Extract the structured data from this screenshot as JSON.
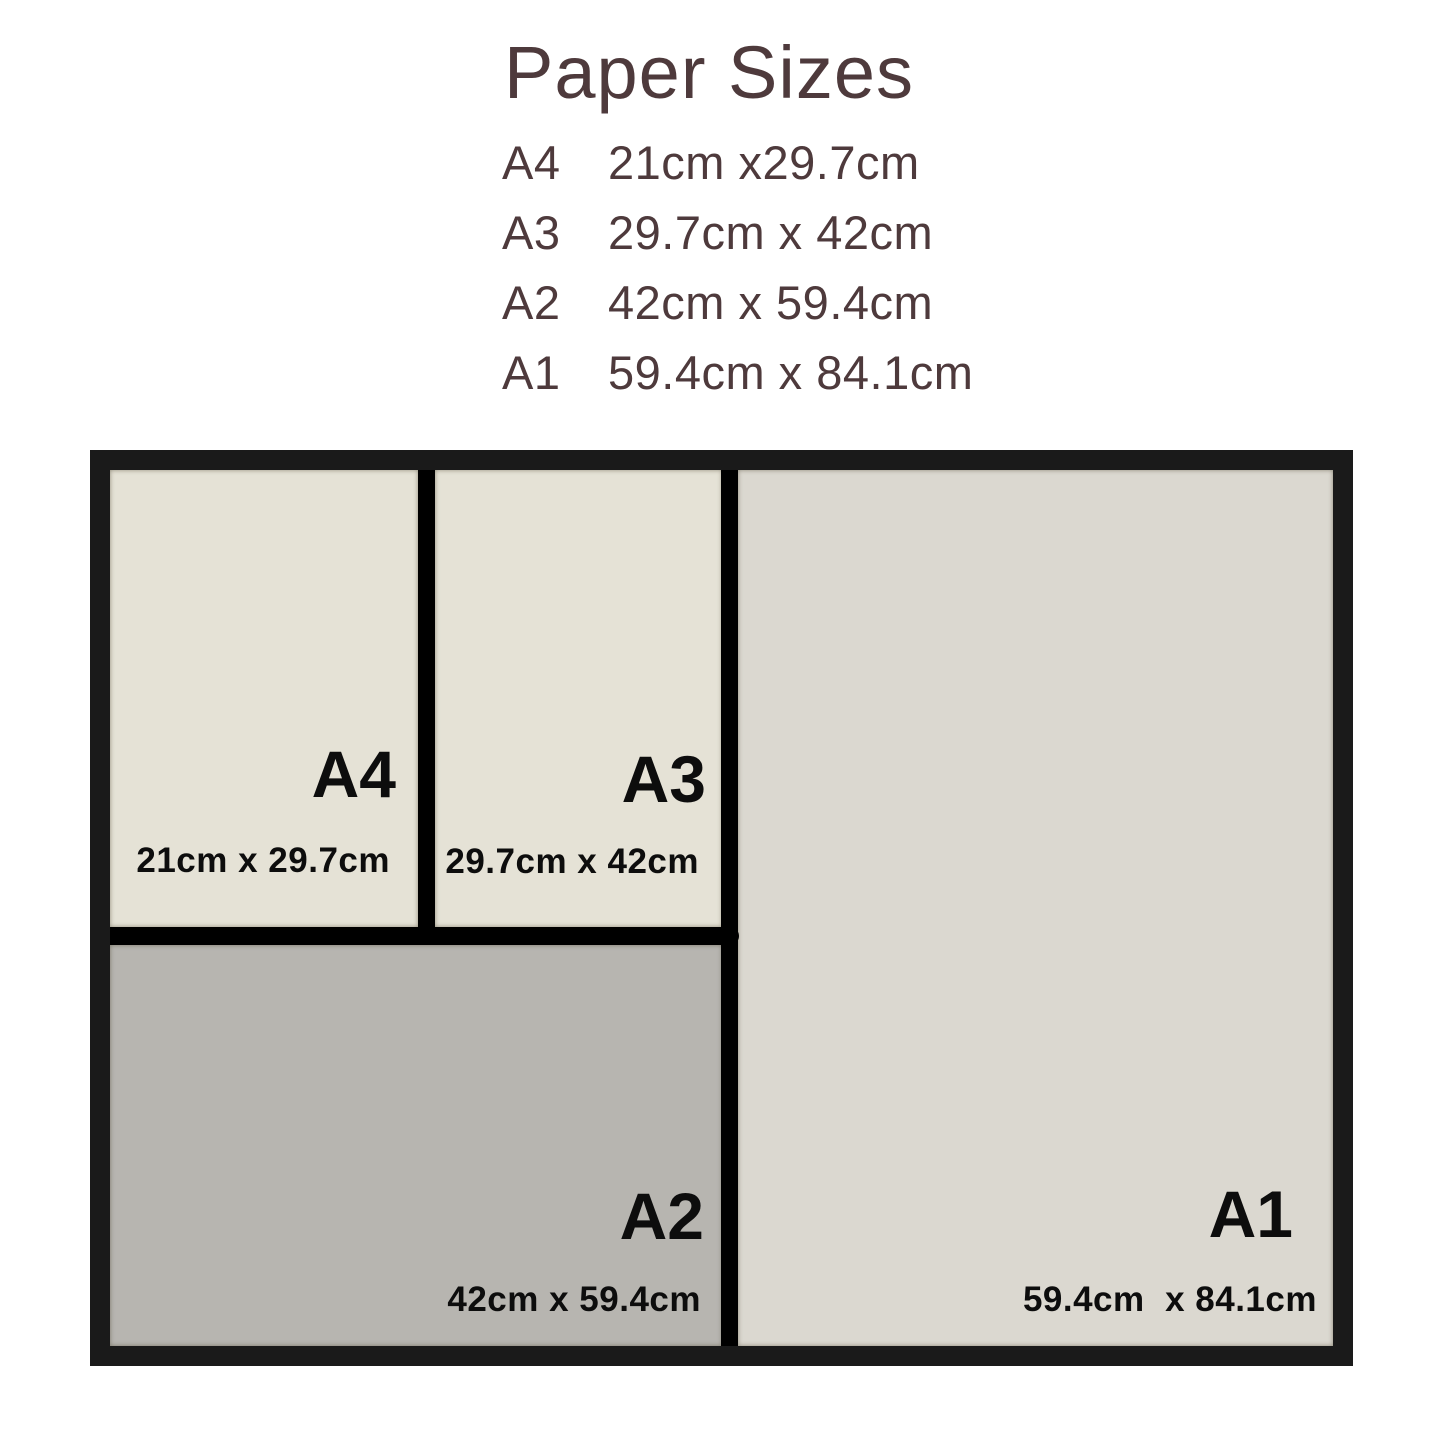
{
  "header": {
    "title": "Paper Sizes",
    "list": [
      {
        "size": "A4",
        "dims": "21cm x29.7cm"
      },
      {
        "size": "A3",
        "dims": "29.7cm x 42cm"
      },
      {
        "size": "A2",
        "dims": "42cm x 59.4cm"
      },
      {
        "size": "A1",
        "dims": "59.4cm x 84.1cm"
      }
    ]
  },
  "diagram": {
    "papers": [
      {
        "name": "A4",
        "dims": "21cm x 29.7cm"
      },
      {
        "name": "A3",
        "dims": "29.7cm x 42cm"
      },
      {
        "name": "A2",
        "dims": "42cm x 59.4cm"
      },
      {
        "name": "A1",
        "dims": "59.4cm  x 84.1cm"
      }
    ]
  },
  "colors": {
    "title_text": "#4e3a3c",
    "frame": "#1a1a1a",
    "divider": "#000000",
    "paper_a4": "#e5e2d6",
    "paper_a3": "#e5e2d6",
    "paper_a2": "#b7b5b0",
    "paper_a1": "#dbd8d0",
    "label_text": "#0d0d0d"
  }
}
